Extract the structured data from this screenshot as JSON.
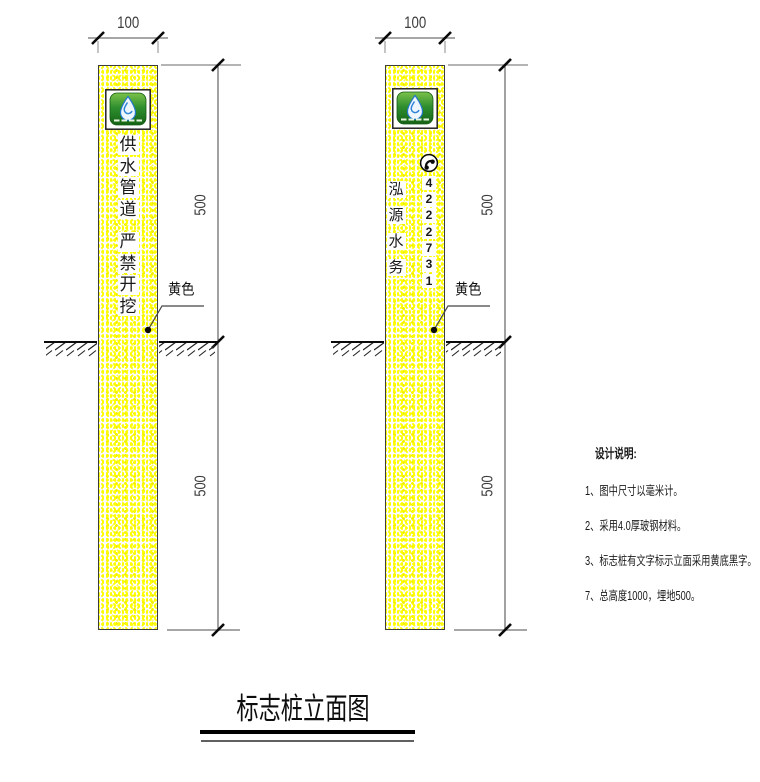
{
  "drawing_title": "标志桩立面图",
  "posts": [
    {
      "side": "left",
      "width_dim": "100",
      "upper_dim": "500",
      "lower_dim": "500",
      "color_callout": "黄色",
      "line1": "供水管道",
      "line2": "严禁开挖"
    },
    {
      "side": "right",
      "width_dim": "100",
      "upper_dim": "500",
      "lower_dim": "500",
      "color_callout": "黄色",
      "company": "泓源水务",
      "phone": "4222731"
    }
  ],
  "notes": {
    "heading": "设计说明:",
    "items": [
      "1、图中尺寸以毫米计。",
      "2、采用4.0厚玻钢材料。",
      "3、标志桩有文字标示立面采用黄底黑字。",
      "7、总高度1000，埋地500。"
    ]
  },
  "icons": {
    "logo": "water-company-logo",
    "phone": "phone-icon"
  },
  "colors": {
    "post_yellow": "#ffff00",
    "logo_green": "#2f8f2f",
    "dimension_line": "#888888",
    "ink": "#1a1a1a"
  }
}
